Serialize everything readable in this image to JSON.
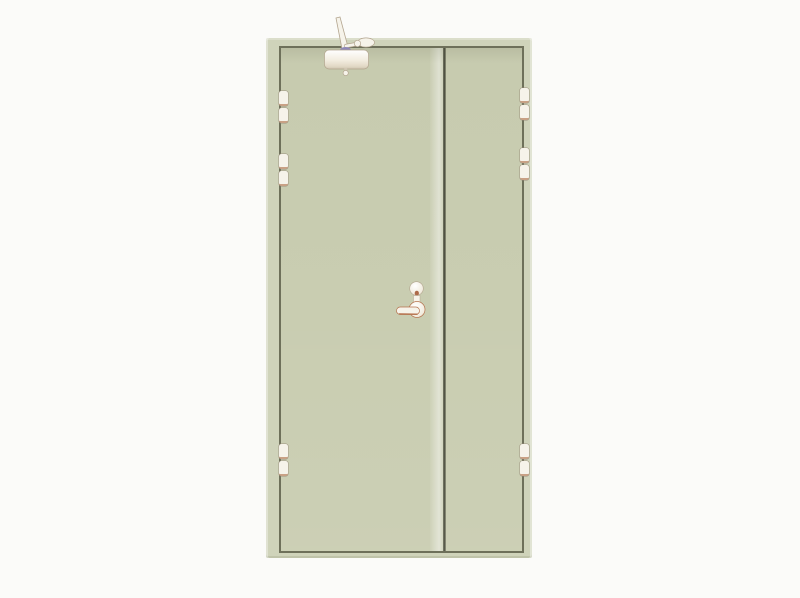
{
  "scene": {
    "subject": "double-leaf steel fire door, closed, front view",
    "description": "Product photo of a pale sage-green unequal double-leaf steel door on a plain white background; wide active leaf on the left with overhead door closer and lever handle, narrow inactive leaf on the right; three barrel hinges on each side",
    "parts": {
      "frame": "door frame",
      "active_leaf": "wide active leaf with closer and handle",
      "inactive_leaf": "narrow inactive leaf",
      "door_closer": "overhead door closer with articulated arm, top of active leaf",
      "handle": "lever handle with cylinder escutcheon above",
      "hinge_count": 6,
      "hinges_per_side": 3
    },
    "colors": {
      "background": "#fbfbf9",
      "frame": "#cfd3ba",
      "leaf": "#c9cdb1",
      "leaf_highlight": "#d6d9c0",
      "seam": "#6e705a",
      "gap": "#5c5e4c",
      "hardware": "#f6f3ea",
      "hardware_shadow": "#cfc5b2",
      "hardware_outline": "#b3a58f",
      "hinge_cap": "#c9a185",
      "closer_pivot": "#8f87b8",
      "handle_shadow": "#b5714c",
      "handle_dot": "#ad6a4a"
    }
  }
}
